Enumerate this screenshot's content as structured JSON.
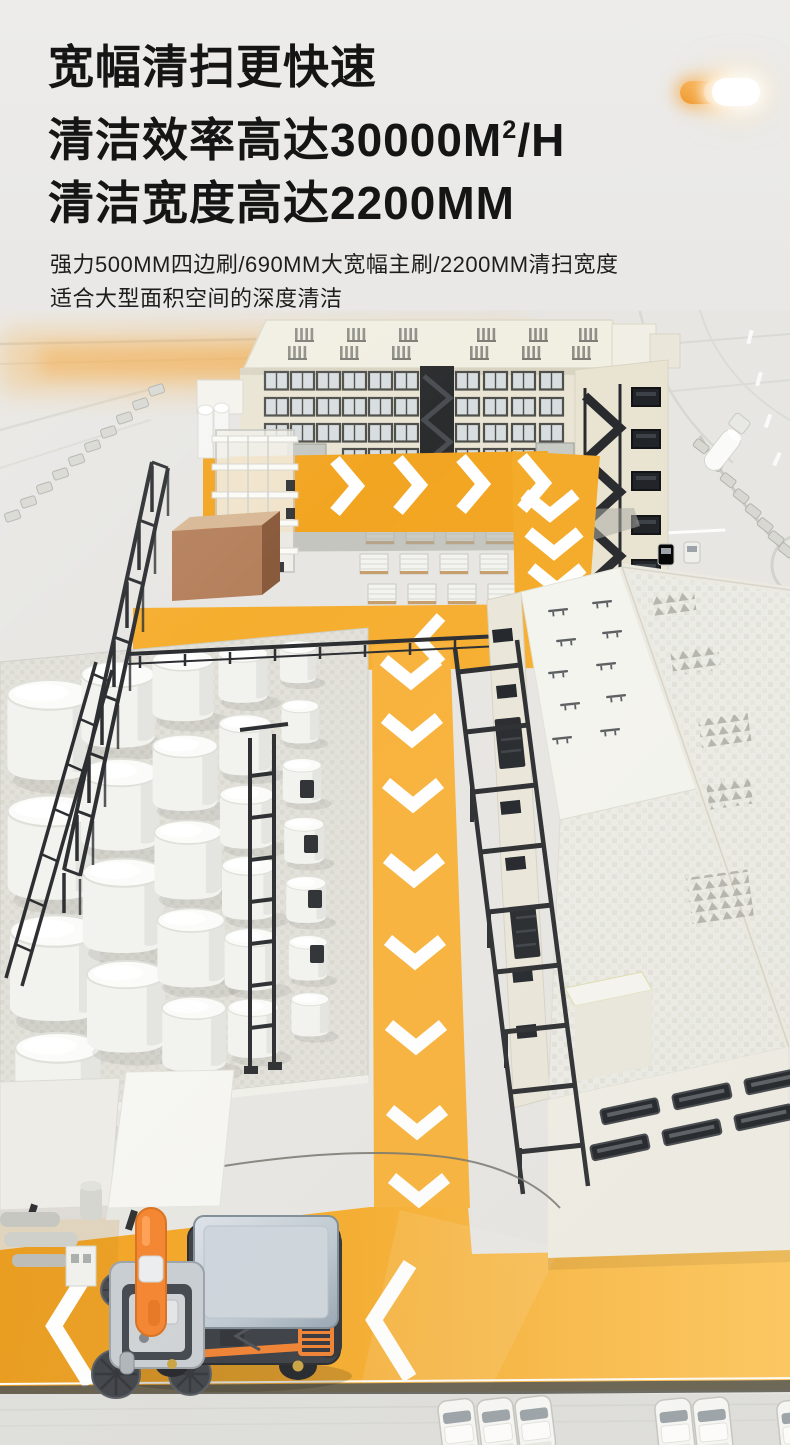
{
  "page": {
    "width": 790,
    "height": 1445
  },
  "header": {
    "line1": "宽幅清扫更快速",
    "line2_prefix": "清洁效率高达30000M",
    "line2_sup": "2",
    "line2_suffix": "/H",
    "line3": "清洁宽度高达2200MM",
    "color": "#151515"
  },
  "subheader": {
    "line1": "强力500MM四边刷/690MM大宽幅主刷/2200MM清扫宽度",
    "line2": "适合大型面积空间的深度清洁",
    "color": "#1d1d1d"
  },
  "toggle_decoration": {
    "on_color": "#F2A33A",
    "glow_color": "#FFD9A3",
    "off_color": "#FFFFFF"
  },
  "scene": {
    "description": "isometric factory campus with yellow sweeping route and sweeper vehicle",
    "palette": {
      "route_yellow": "#F5A928",
      "route_yellow_bright": "#F9B440",
      "arrow_white": "#FFFFFF",
      "building_beige": "#EBE6D4",
      "building_cream": "#F0EEE6",
      "steel_black": "#2B2D30",
      "tank_white": "#F3F3F0",
      "platform_gray": "#E0E0D9",
      "brown_box": "#B27C55",
      "sweeper_orange": "#F5832D",
      "sweeper_body": "#3A3E44",
      "sweeper_roof_silver": "#C2CBD3",
      "car_white": "#F7F7F5"
    }
  }
}
